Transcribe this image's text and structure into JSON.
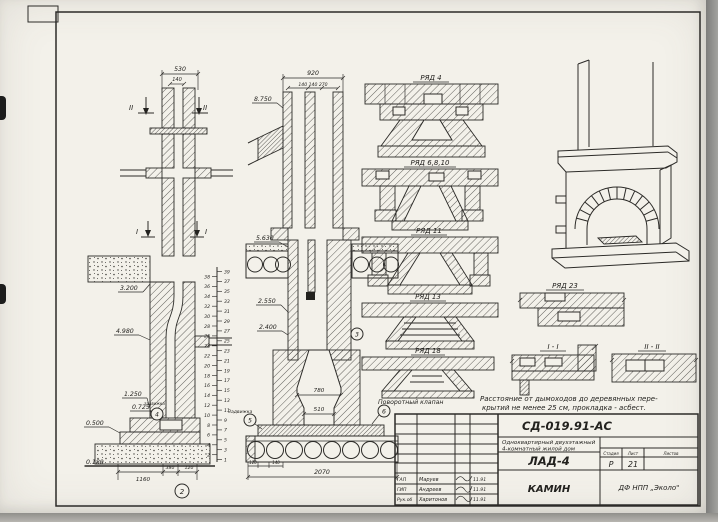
{
  "left_section": {
    "dim_530": "530",
    "dim_140": "140",
    "mark_II": "II",
    "mark_I": "I",
    "levels": {
      "l3200": "3.200",
      "l4980": "4.980",
      "l1250": "1.250",
      "l0725": "0.725",
      "l0500": "0.500",
      "l0180": "0.180"
    },
    "small_label": "задвижка",
    "dims_bottom": {
      "d1160": "1160",
      "d380": "380",
      "d120": "120"
    },
    "callout_2": "2",
    "callout_4": "4"
  },
  "ladder": {
    "left": [
      38,
      36,
      34,
      32,
      30,
      28,
      26,
      24,
      22,
      20,
      18,
      16,
      14,
      12,
      10,
      8,
      6,
      4,
      2
    ],
    "right": [
      39,
      37,
      35,
      33,
      31,
      29,
      27,
      25,
      23,
      21,
      19,
      17,
      15,
      13,
      11,
      9,
      7,
      5,
      3,
      1
    ]
  },
  "mid_section": {
    "dim_920": "920",
    "dim_sub": "140 140 270",
    "levels": {
      "l8750": "8.750",
      "l5630": "5.630",
      "l2550": "2.550",
      "l2400": "2.400"
    },
    "dim_780": "780",
    "dim_510": "510",
    "dims_bottom": {
      "d120": "120",
      "d140": "140",
      "d2070": "2070"
    },
    "label_zadvizhka": "Задвижка",
    "label_povorotny": "Поворотный клапан",
    "callout_3": "3",
    "callout_5": "5",
    "callout_6": "6"
  },
  "plans": {
    "r4": "РЯД 4",
    "r6810": "РЯД 6,8,10",
    "r11": "РЯД 11",
    "r13": "РЯД 13",
    "r18": "РЯД 18",
    "r23": "РЯД 23",
    "s11": "I - I",
    "s22": "II - II"
  },
  "note": {
    "line1": "Расстояние от дымоходов до деревянных пере-",
    "line2": "крытий не менее 25 см, прокладка - асбест."
  },
  "titleblock": {
    "doc_code": "СД-019.91-АС",
    "project_line1": "Одноквартирный двухэтажный",
    "project_line2": "4-комнатный жилой дом",
    "sheet_code": "ЛАД-4",
    "drawing_title": "КАМИН",
    "org": "ДФ НПП „Эколо\"",
    "stage_header": "Стадия",
    "sheet_header": "Лист",
    "sheets_header": "Листов",
    "stage": "Р",
    "sheet_no": "21",
    "sign_rows": [
      {
        "role": "ГАП",
        "name": "Маруев",
        "date": "11.91"
      },
      {
        "role": "ГИП",
        "name": "Андреев",
        "date": "11.91"
      },
      {
        "role": "Рук.об",
        "name": "Харитонов",
        "date": "11.91"
      }
    ]
  }
}
